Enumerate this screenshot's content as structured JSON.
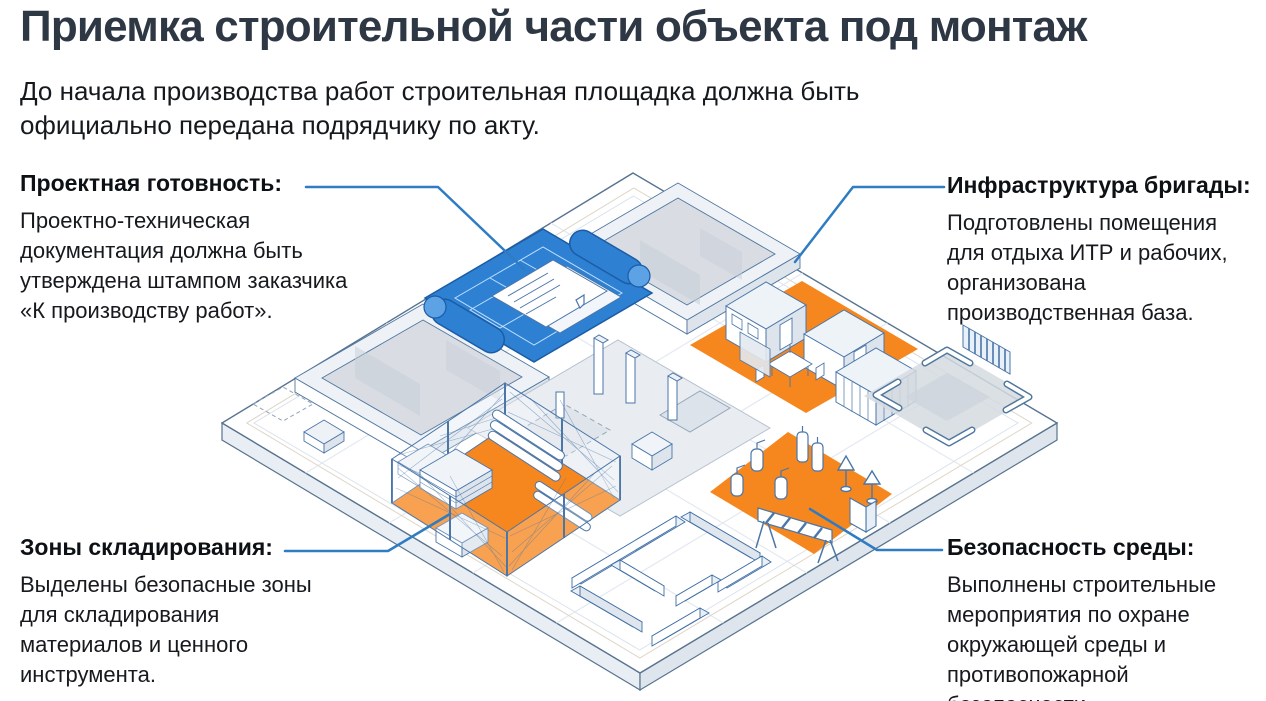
{
  "page": {
    "title": "Приемка строительной части объекта под монтаж",
    "subtitle_lines": [
      "До начала производства работ строительная площадка должна быть",
      "официально передана подрядчику по акту."
    ]
  },
  "callouts": {
    "project_readiness": {
      "title": "Проектная готовность:",
      "body_lines": [
        "Проектно-техническая",
        "документация должна быть",
        "утверждена штампом заказчика",
        "«К производству работ»."
      ]
    },
    "brigade_infrastructure": {
      "title": "Инфраструктура бригады:",
      "body_lines": [
        "Подготовлены помещения",
        "для отдыха ИТР и рабочих,",
        "организована",
        "производственная база."
      ]
    },
    "storage_zones": {
      "title": "Зоны складирования:",
      "body_lines": [
        "Выделены безопасные зоны",
        "для складирования",
        "материалов и ценного",
        "инструмента."
      ]
    },
    "environment_safety": {
      "title": "Безопасность среды:",
      "body_lines": [
        "Выполнены строительные",
        "мероприятия по охране",
        "окружающей среды и",
        "противопожарной",
        "безопасности."
      ]
    }
  },
  "illustration": {
    "elements": [
      "isometric-site-platform",
      "blueprint-scroll",
      "building-shell-top",
      "building-shell-left",
      "brigade-zone-trailers",
      "equipment-pad",
      "foundation-works",
      "fenced-storage-zone",
      "fire-safety-zone",
      "floor-plan-walls"
    ],
    "colors": {
      "accent_blue": "#2e7cc3",
      "blueprint_blue": "#2e80d2",
      "zone_orange": "#f6871f",
      "outline_blue": "#4a76a8",
      "title_dark": "#2e3744",
      "slab_gray": "#d9dde3"
    }
  }
}
